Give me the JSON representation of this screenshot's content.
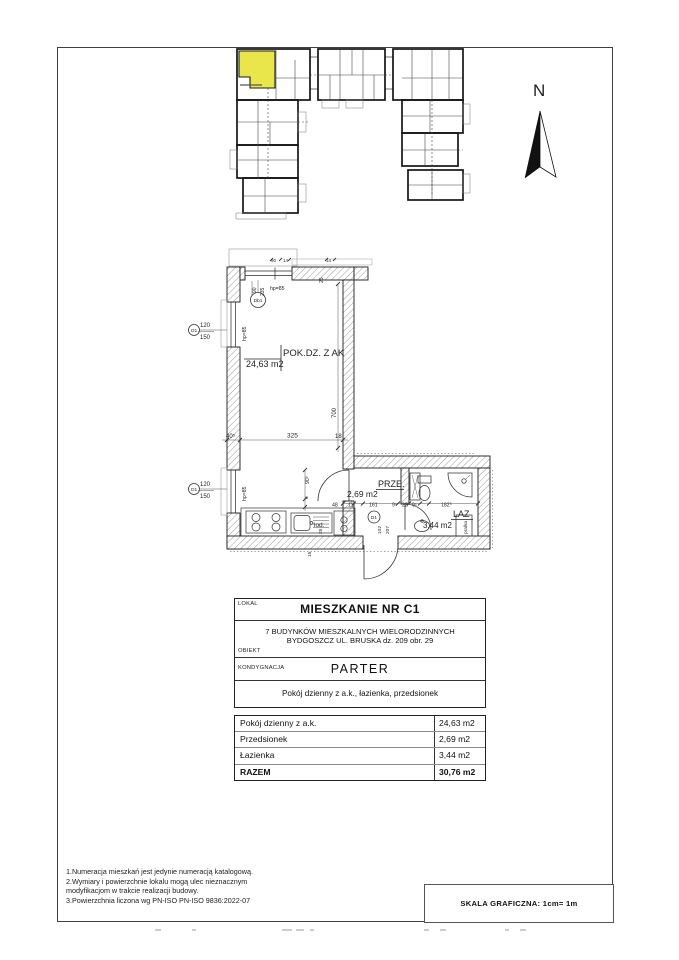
{
  "compass": {
    "label": "N"
  },
  "colors": {
    "highlight": "#e9e64b"
  },
  "plan": {
    "texts": [
      {
        "t": "POK.DZ. Z AK",
        "x": 283,
        "y": 356,
        "s": 9.5
      },
      {
        "t": "24,63 m2",
        "x": 246,
        "y": 367,
        "s": 9
      },
      {
        "t": "PRZE.",
        "x": 378,
        "y": 487,
        "s": 9
      },
      {
        "t": "2,69 m2",
        "x": 347,
        "y": 497,
        "s": 8.5
      },
      {
        "t": "LAZ",
        "x": 453,
        "y": 517,
        "s": 9
      },
      {
        "t": "3,44 m2",
        "x": 423,
        "y": 528,
        "s": 8
      },
      {
        "t": "lod.",
        "x": 314,
        "y": 527,
        "s": 6.5
      },
      {
        "t": "pralka",
        "x": 467,
        "y": 534,
        "s": 4.8,
        "r": -90
      },
      {
        "t": "700",
        "x": 336,
        "y": 418,
        "s": 6,
        "r": -90
      },
      {
        "t": "325",
        "x": 287,
        "y": 437.5,
        "s": 6.5
      },
      {
        "t": "40⁵",
        "x": 226,
        "y": 438,
        "s": 6
      },
      {
        "t": "18",
        "x": 335,
        "y": 438,
        "s": 6
      },
      {
        "t": "120",
        "x": 200,
        "y": 327,
        "s": 6
      },
      {
        "t": "150",
        "x": 200,
        "y": 339,
        "s": 6
      },
      {
        "t": "O1",
        "x": 194,
        "y": 332,
        "s": 4.8,
        "a": "middle"
      },
      {
        "t": "hp=85",
        "x": 246,
        "y": 341,
        "s": 5.2,
        "r": -90
      },
      {
        "t": "120",
        "x": 200,
        "y": 486,
        "s": 6
      },
      {
        "t": "150",
        "x": 200,
        "y": 498,
        "s": 6
      },
      {
        "t": "O1",
        "x": 194,
        "y": 491,
        "s": 4.8,
        "a": "middle"
      },
      {
        "t": "hp=85",
        "x": 246,
        "y": 501,
        "s": 5.2,
        "r": -90
      },
      {
        "t": "hp=85",
        "x": 270,
        "y": 290,
        "s": 5.2
      },
      {
        "t": "90",
        "x": 256,
        "y": 293,
        "s": 5,
        "r": -90
      },
      {
        "t": "235",
        "x": 264,
        "y": 296,
        "s": 5,
        "r": -90
      },
      {
        "t": "Db1",
        "x": 258,
        "y": 302,
        "s": 4.8,
        "a": "middle"
      },
      {
        "t": "25",
        "x": 323,
        "y": 283,
        "s": 5,
        "r": -90
      },
      {
        "t": "90⁵",
        "x": 309,
        "y": 484,
        "s": 5.2,
        "r": -90
      },
      {
        "t": "6",
        "x": 308,
        "y": 499,
        "s": 4.8,
        "r": -90
      },
      {
        "t": "48",
        "x": 332,
        "y": 506.5,
        "s": 5.2
      },
      {
        "t": "11",
        "x": 348,
        "y": 506.5,
        "s": 5.2
      },
      {
        "t": "161",
        "x": 369,
        "y": 506.5,
        "s": 5.2
      },
      {
        "t": "9⁵",
        "x": 392,
        "y": 506.5,
        "s": 5
      },
      {
        "t": "22",
        "x": 402,
        "y": 506.5,
        "s": 5.2
      },
      {
        "t": "9⁵",
        "x": 412,
        "y": 506.5,
        "s": 5
      },
      {
        "t": "182⁵",
        "x": 441,
        "y": 506.5,
        "s": 5.2
      },
      {
        "t": "102",
        "x": 381,
        "y": 534,
        "s": 4.8,
        "r": -90
      },
      {
        "t": "207",
        "x": 389,
        "y": 534,
        "s": 4.8,
        "r": -90
      },
      {
        "t": "D1",
        "x": 374,
        "y": 519,
        "s": 4.8,
        "a": "middle"
      },
      {
        "t": "25",
        "x": 322,
        "y": 534,
        "s": 4.8,
        "r": -90
      },
      {
        "t": "15",
        "x": 311,
        "y": 557,
        "s": 4.8,
        "r": -90
      },
      {
        "t": "90",
        "x": 271,
        "y": 262,
        "s": 4.5
      },
      {
        "t": "14",
        "x": 283,
        "y": 262,
        "s": 4.5
      },
      {
        "t": "14",
        "x": 326,
        "y": 262,
        "s": 4.5
      }
    ]
  },
  "info_table": {
    "lokal_label": "LOKAL",
    "lokal_value": "MIESZKANIE NR C1",
    "obiekt_label": "OBIEKT",
    "obiekt_line1": "7 BUDYNKÓW MIESZKALNYCH WIELORODZINNYCH",
    "obiekt_line2": "BYDGOSZCZ UL. BRUSKA dz. 209 obr. 29",
    "kond_label": "KONDYGNACJA",
    "kond_value": "PARTER",
    "rooms_value": "Pokój dzienny z a.k., łazienka, przedsionek",
    "areas": [
      {
        "name": "Pokój dzienny z a.k.",
        "area": "24,63 m2"
      },
      {
        "name": "Przedsionek",
        "area": "2,69 m2"
      },
      {
        "name": "Łazienka",
        "area": "3,44 m2"
      },
      {
        "name": "RAZEM",
        "area": "30,76 m2"
      }
    ]
  },
  "footer": {
    "notes": [
      "1.Numeracja mieszkań jest jedynie numeracją katalogową.",
      "2.Wymiary i powierzchnie lokalu mogą ulec nieznacznym",
      "modyfikacjom w trakcie realizacji budowy.",
      "3.Powierzchnia liczona wg PN-ISO PN-ISO 9836:2022-07"
    ],
    "scale_label": "SKALA GRAFICZNA: 1cm= 1m"
  }
}
